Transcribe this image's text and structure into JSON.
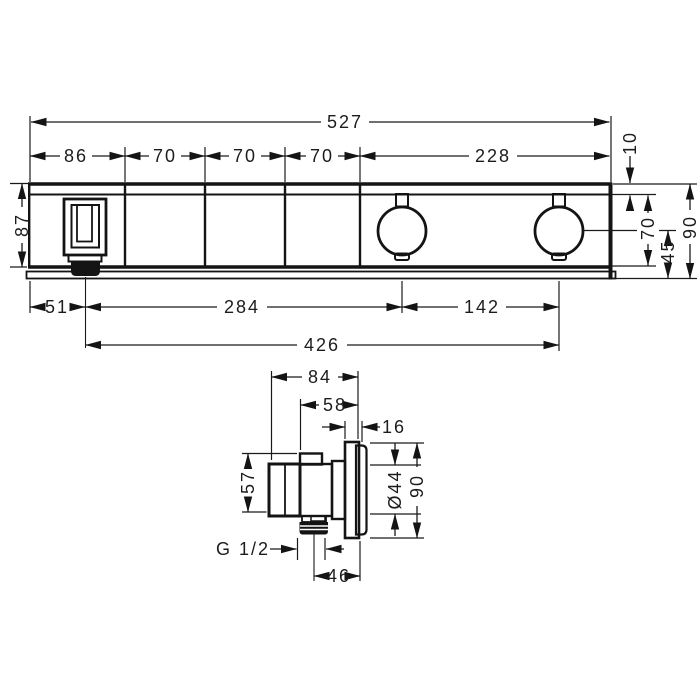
{
  "colors": {
    "ink": "#141414",
    "text": "#1c1c1c",
    "background": "#ffffff"
  },
  "top_view": {
    "length_total": "527",
    "seg_1": "86",
    "seg_2": "70",
    "seg_3": "70",
    "seg_4": "70",
    "seg_5": "228",
    "height_body": "87",
    "offset_top": "10",
    "handle_height": "70",
    "center_to_bottom": "45",
    "height_total": "90",
    "edge_to_outlet": "51",
    "outlet_to_knob1": "284",
    "knob_spacing": "142",
    "outlet_to_knob2": "426"
  },
  "side_view": {
    "depth_total": "84",
    "depth_front": "58",
    "plate_depth": "16",
    "body_height": "57",
    "knob_diameter": "Ø44",
    "plate_height": "90",
    "thread": "G 1/2",
    "axis_to_face": "46"
  }
}
